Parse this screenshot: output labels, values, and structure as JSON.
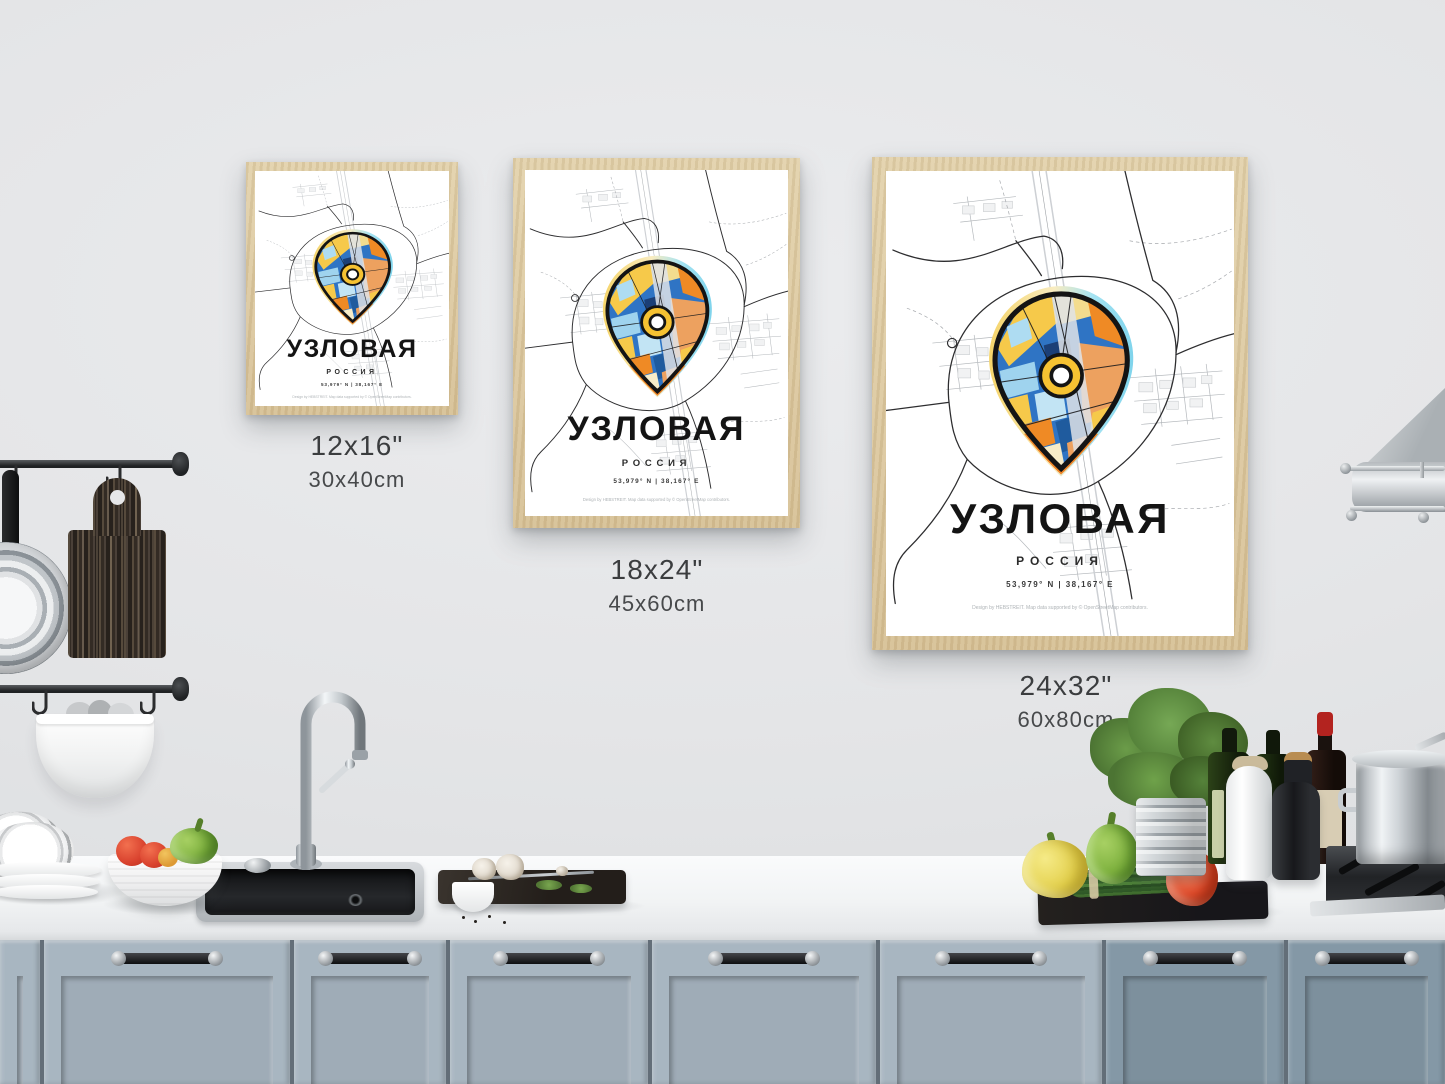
{
  "poster": {
    "title": "УЗЛОВАЯ",
    "country": "РОССИЯ",
    "coordinates": "53,979° N | 38,167° E",
    "credit": "Design by HEBSTREIT. Map data supported by © OpenStreetMap contributors."
  },
  "size_labels": [
    {
      "inches": "12x16\"",
      "cm": "30x40cm"
    },
    {
      "inches": "18x24\"",
      "cm": "45x60cm"
    },
    {
      "inches": "24x32\"",
      "cm": "60x80cm"
    }
  ],
  "colors": {
    "frame_wood": "#dcc9a0",
    "pin_blue": "#2f74c4",
    "pin_orange": "#ef8a25",
    "pin_salmon": "#eda15f",
    "pin_yellow": "#f6c94a",
    "halo_cyan": "#7fd4ec",
    "halo_yellow": "#f5d469",
    "cabinet_light": "#a8b6c1",
    "cabinet_dark": "#8498a6",
    "wall": "#e6e7e9"
  }
}
